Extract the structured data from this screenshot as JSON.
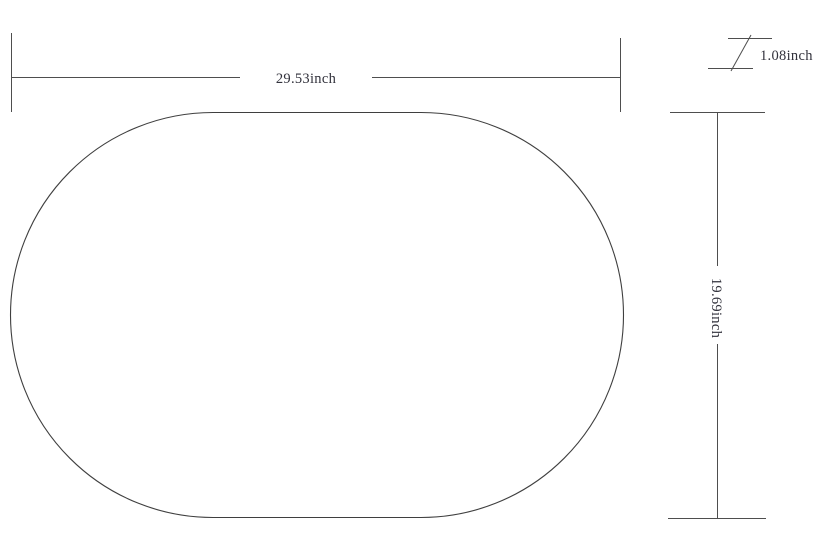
{
  "colors": {
    "background": "#ffffff",
    "line": "#4e4e4e",
    "outline": "#3f3f3f",
    "text": "#32323c"
  },
  "dimensions": {
    "width": {
      "label": "29.53inch",
      "value": 29.53,
      "unit": "inch"
    },
    "height": {
      "label": "19.69inch",
      "value": 19.69,
      "unit": "inch"
    },
    "thickness": {
      "label": "1.08inch",
      "value": 1.08,
      "unit": "inch"
    }
  }
}
